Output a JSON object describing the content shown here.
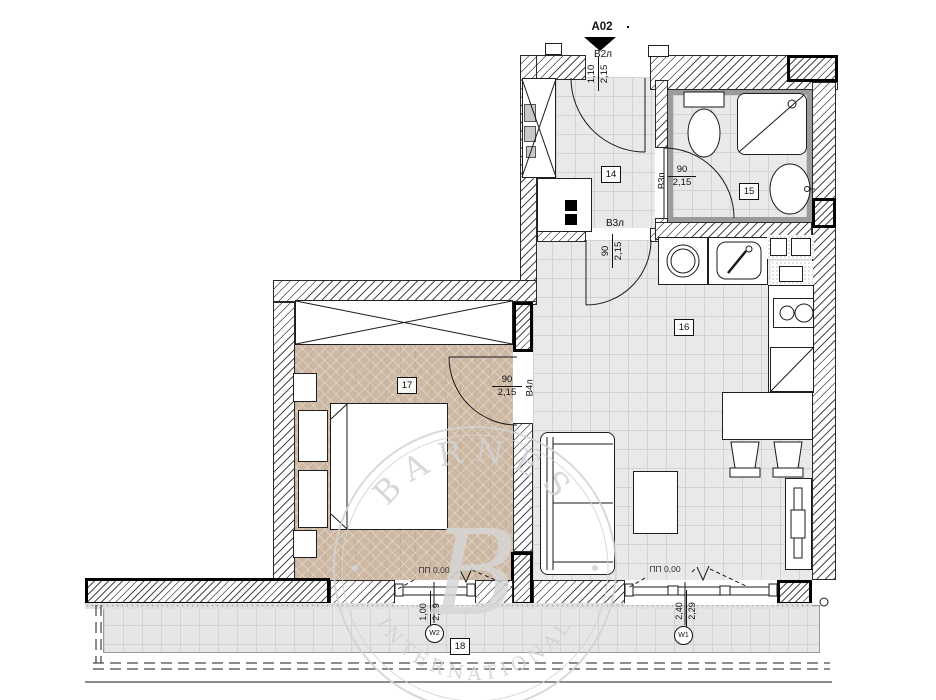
{
  "marker": {
    "code": "A02"
  },
  "doors": {
    "entry": {
      "label": "В2л",
      "width": "1,10",
      "height": "2,15"
    },
    "bath": {
      "label": "В3п",
      "width": "90",
      "height": "2,15"
    },
    "living": {
      "label": "В3л",
      "width": "90",
      "height": "2,15"
    },
    "bedroom": {
      "label": "В4л",
      "width": "90",
      "height": "2,15"
    }
  },
  "rooms": {
    "hall": "14",
    "bath": "15",
    "living": "16",
    "bedroom": "17",
    "terrace": "18"
  },
  "windows": {
    "bedroom": {
      "tag": "W2",
      "width": "1,00",
      "height": "2,29",
      "sill": "ПП 0,00"
    },
    "living": {
      "tag": "W1",
      "width": "2,40",
      "height": "2,29",
      "sill": "ПП 0,00"
    }
  },
  "watermark": {
    "arc_top": "BARNES",
    "monogram": "B",
    "arc_bottom": "INTERNATIONAL"
  },
  "colors": {
    "parquet": "#ccb8a3",
    "floor_tile": "#e9e9e9",
    "tile_line": "#d3d3d3",
    "hatch_line": "#4a4a4a",
    "bath_band": "#9b9b9b",
    "watermark": "#d2d2d2"
  }
}
